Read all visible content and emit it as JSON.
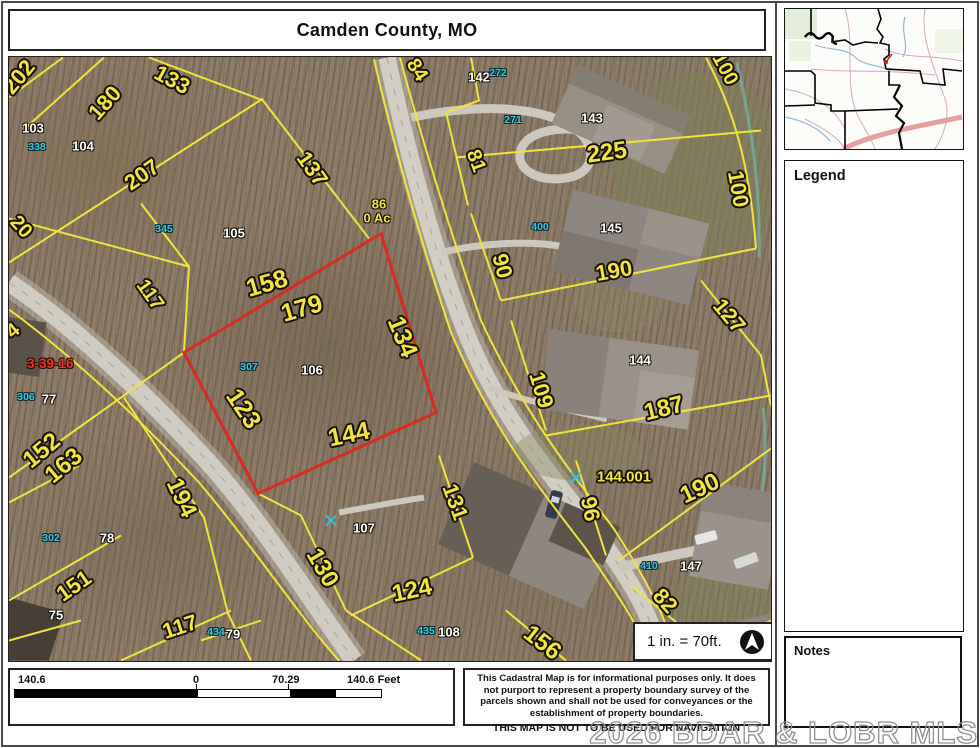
{
  "title": "Camden County, MO",
  "inset_map": {
    "counties": [
      {
        "name": "BENTON",
        "x": 1,
        "y": 25
      },
      {
        "name": "MORGAN",
        "x": 43,
        "y": 13
      },
      {
        "name": "MILLER",
        "x": 109,
        "y": 33
      },
      {
        "name": "HICKORY",
        "x": 0,
        "y": 81
      },
      {
        "name": "DALLAS",
        "x": 25,
        "y": 113
      },
      {
        "name": "LACLEDE",
        "x": 68,
        "y": 117
      },
      {
        "name": "PULASKI",
        "x": 121,
        "y": 101
      }
    ],
    "us_highway_shields": [
      {
        "label": "54",
        "x": 100,
        "y": 6
      },
      {
        "label": "54",
        "x": 88,
        "y": 44
      },
      {
        "label": "54",
        "x": 83,
        "y": 68
      }
    ],
    "interstate_shields": [
      {
        "label": "44",
        "x": 110,
        "y": 117
      }
    ]
  },
  "legend": {
    "title": "Legend",
    "items": [
      {
        "label": "Highway",
        "swatch": "none",
        "indent": 1,
        "size": "md"
      },
      {
        "label": "Interstate Highway",
        "swatch": "interstate",
        "indent": 2,
        "size": "sm"
      },
      {
        "label": "US Highway",
        "swatch": "us",
        "indent": 2,
        "size": "sm"
      },
      {
        "label": "Numbered State Highway",
        "swatch": "numbered",
        "indent": 2,
        "size": "sm"
      },
      {
        "label": "Lettered State Highway",
        "swatch": "lettered",
        "indent": 2,
        "size": "sm"
      },
      {
        "label": "Road",
        "swatch": "road",
        "indent": 0,
        "size": "md"
      },
      {
        "label": "Address Point",
        "swatch": "address",
        "indent": 0,
        "size": "md"
      },
      {
        "label": "Condo Point",
        "swatch": "condo",
        "indent": 0,
        "size": "md"
      },
      {
        "label": "Parcel",
        "swatch": "parcel",
        "indent": 0,
        "size": "md"
      },
      {
        "label": "Corporate Limit Line",
        "swatch": "corporate",
        "indent": 0,
        "size": "md"
      },
      {
        "label": "Land Hook",
        "swatch": "none",
        "indent": 1,
        "size": "md"
      },
      {
        "label": "DASHED LAND HOOK",
        "swatch": "dashhook",
        "indent": 2,
        "size": "xs"
      },
      {
        "label": "SOLID LAND HOOK",
        "swatch": "solidhook",
        "indent": 2,
        "size": "xs"
      },
      {
        "label": "Original Lot",
        "swatch": "origlot",
        "indent": 0,
        "size": "md"
      },
      {
        "label": "Section",
        "swatch": "section",
        "indent": 0,
        "size": "md"
      },
      {
        "label": "County Boundary",
        "swatch": "county",
        "indent": 0,
        "size": "md"
      }
    ]
  },
  "notes": {
    "title": "Notes"
  },
  "scale_note": "1 in. = 70ft.",
  "scalebar": {
    "left": "140.6",
    "zero": "0",
    "mid": "70.29",
    "right": "140.6 Feet"
  },
  "disclaimer": {
    "body": "This Cadastral Map is for informational purposes only.  It does not purport to represent a property boundary survey of the parcels shown and shall not be used for conveyances or the establishment of property boundaries.",
    "warning": "THIS MAP IS NOT TO BE USED FOR NAVIGATION"
  },
  "watermark": "2026 BDAR & LOBR MLS",
  "colors": {
    "parcel_line": "#f2e33b",
    "section_line": "#d92b1f",
    "condo_text": "#3cc6da",
    "dimension_text": "#f3e53e",
    "interstate": "#dd8c8c"
  },
  "map": {
    "streets": [
      {
        "name": "BROOKHAVEN LN",
        "x": 447,
        "y": 228,
        "rot": 72
      },
      {
        "name": "FERNCREST LN",
        "x": 234,
        "y": 465,
        "rot": 57
      }
    ],
    "section_label": "3-39-16",
    "area_label": {
      "lot": "86",
      "acreage": "0 Ac"
    },
    "address_point_glyph": "A",
    "dimension_labels": [
      {
        "text": "202",
        "x": 10,
        "y": 20,
        "rot": -50,
        "size": 22
      },
      {
        "text": "180",
        "x": 96,
        "y": 46,
        "rot": -48,
        "size": 22
      },
      {
        "text": "133",
        "x": 163,
        "y": 23,
        "rot": 28,
        "size": 22
      },
      {
        "text": "84",
        "x": 408,
        "y": 13,
        "rot": 58,
        "size": 20
      },
      {
        "text": "207",
        "x": 133,
        "y": 118,
        "rot": -35,
        "size": 22
      },
      {
        "text": "137",
        "x": 303,
        "y": 112,
        "rot": 55,
        "size": 22
      },
      {
        "text": "20",
        "x": 12,
        "y": 170,
        "rot": 48,
        "size": 20
      },
      {
        "text": "117",
        "x": 141,
        "y": 238,
        "rot": 55,
        "size": 20
      },
      {
        "text": "4",
        "x": 4,
        "y": 274,
        "rot": -40,
        "size": 20
      },
      {
        "text": "158",
        "x": 258,
        "y": 227,
        "rot": -16,
        "size": 25
      },
      {
        "text": "179",
        "x": 293,
        "y": 252,
        "rot": -16,
        "size": 25
      },
      {
        "text": "134",
        "x": 393,
        "y": 280,
        "rot": 68,
        "size": 25
      },
      {
        "text": "123",
        "x": 234,
        "y": 352,
        "rot": 56,
        "size": 25
      },
      {
        "text": "144",
        "x": 340,
        "y": 378,
        "rot": -12,
        "size": 25
      },
      {
        "text": "81",
        "x": 467,
        "y": 104,
        "rot": 70,
        "size": 20
      },
      {
        "text": "225",
        "x": 598,
        "y": 96,
        "rot": -8,
        "size": 24
      },
      {
        "text": "90",
        "x": 493,
        "y": 209,
        "rot": 75,
        "size": 22
      },
      {
        "text": "190",
        "x": 605,
        "y": 214,
        "rot": -10,
        "size": 22
      },
      {
        "text": "100",
        "x": 716,
        "y": 12,
        "rot": 62,
        "size": 20
      },
      {
        "text": "100",
        "x": 729,
        "y": 132,
        "rot": 80,
        "size": 22
      },
      {
        "text": "127",
        "x": 720,
        "y": 259,
        "rot": 50,
        "size": 22
      },
      {
        "text": "109",
        "x": 532,
        "y": 333,
        "rot": 73,
        "size": 22
      },
      {
        "text": "187",
        "x": 655,
        "y": 352,
        "rot": -14,
        "size": 24
      },
      {
        "text": "144.001",
        "x": 615,
        "y": 420,
        "rot": 0,
        "size": 15
      },
      {
        "text": "96",
        "x": 581,
        "y": 452,
        "rot": 78,
        "size": 22
      },
      {
        "text": "190",
        "x": 691,
        "y": 432,
        "rot": -25,
        "size": 24
      },
      {
        "text": "82",
        "x": 656,
        "y": 544,
        "rot": 48,
        "size": 22
      },
      {
        "text": "156",
        "x": 533,
        "y": 586,
        "rot": 38,
        "size": 24
      },
      {
        "text": "131",
        "x": 446,
        "y": 445,
        "rot": 70,
        "size": 22
      },
      {
        "text": "130",
        "x": 313,
        "y": 511,
        "rot": 60,
        "size": 24
      },
      {
        "text": "124",
        "x": 403,
        "y": 534,
        "rot": -12,
        "size": 24
      },
      {
        "text": "117",
        "x": 171,
        "y": 570,
        "rot": -18,
        "size": 22
      },
      {
        "text": "152",
        "x": 33,
        "y": 394,
        "rot": -40,
        "size": 24
      },
      {
        "text": "163",
        "x": 55,
        "y": 409,
        "rot": -40,
        "size": 24
      },
      {
        "text": "194",
        "x": 172,
        "y": 441,
        "rot": 65,
        "size": 24
      },
      {
        "text": "151",
        "x": 65,
        "y": 529,
        "rot": -35,
        "size": 22
      }
    ],
    "parcel_numbers": [
      {
        "text": "103",
        "x": 24,
        "y": 71
      },
      {
        "text": "104",
        "x": 74,
        "y": 89
      },
      {
        "text": "105",
        "x": 225,
        "y": 176
      },
      {
        "text": "106",
        "x": 303,
        "y": 313
      },
      {
        "text": "107",
        "x": 355,
        "y": 471
      },
      {
        "text": "108",
        "x": 440,
        "y": 575
      },
      {
        "text": "142",
        "x": 470,
        "y": 20
      },
      {
        "text": "143",
        "x": 583,
        "y": 61
      },
      {
        "text": "145",
        "x": 602,
        "y": 171
      },
      {
        "text": "144",
        "x": 631,
        "y": 303
      },
      {
        "text": "147",
        "x": 682,
        "y": 509
      },
      {
        "text": "77",
        "x": 40,
        "y": 342
      },
      {
        "text": "78",
        "x": 98,
        "y": 481
      },
      {
        "text": "75",
        "x": 47,
        "y": 558
      },
      {
        "text": "79",
        "x": 224,
        "y": 577
      }
    ],
    "condo_numbers": [
      {
        "text": "338",
        "x": 28,
        "y": 90
      },
      {
        "text": "345",
        "x": 155,
        "y": 172
      },
      {
        "text": "307",
        "x": 240,
        "y": 310
      },
      {
        "text": "272",
        "x": 489,
        "y": 16
      },
      {
        "text": "271",
        "x": 504,
        "y": 63
      },
      {
        "text": "400",
        "x": 531,
        "y": 170
      },
      {
        "text": "306",
        "x": 17,
        "y": 340
      },
      {
        "text": "302",
        "x": 42,
        "y": 481
      },
      {
        "text": "434",
        "x": 207,
        "y": 575
      },
      {
        "text": "435",
        "x": 417,
        "y": 574
      },
      {
        "text": "410",
        "x": 640,
        "y": 509
      }
    ],
    "address_points": [
      {
        "x": 604,
        "y": 55
      },
      {
        "x": 652,
        "y": 171
      },
      {
        "x": 647,
        "y": 301
      },
      {
        "x": 375,
        "y": 470
      },
      {
        "x": 755,
        "y": 480
      }
    ]
  }
}
